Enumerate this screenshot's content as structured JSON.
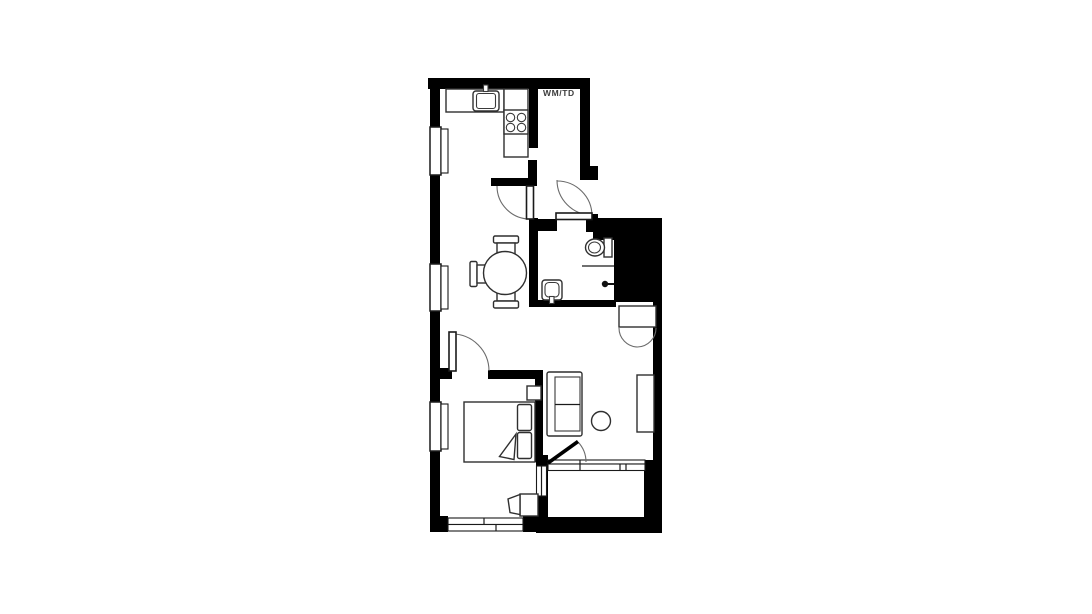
{
  "canvas": {
    "width": 1092,
    "height": 614,
    "background": "#ffffff"
  },
  "colors": {
    "wall": "#000000",
    "furniture_stroke": "#2f2f2f",
    "door_swing": "#6b6b6b",
    "label_text": "#3c3c3c",
    "background": "#ffffff"
  },
  "labels": {
    "utility": "WM/TD"
  },
  "fixtures": [
    "kitchen-counter",
    "kitchen-sink",
    "stove-4-burner",
    "dining-table-round",
    "dining-chair",
    "toilet",
    "wash-basin",
    "shower-head",
    "service-shaft",
    "wardrobe",
    "sofa",
    "side-table-round",
    "sideboard",
    "double-bed",
    "pillow",
    "nightstand",
    "desk",
    "desk-chair",
    "window",
    "door-swing",
    "balcony"
  ]
}
